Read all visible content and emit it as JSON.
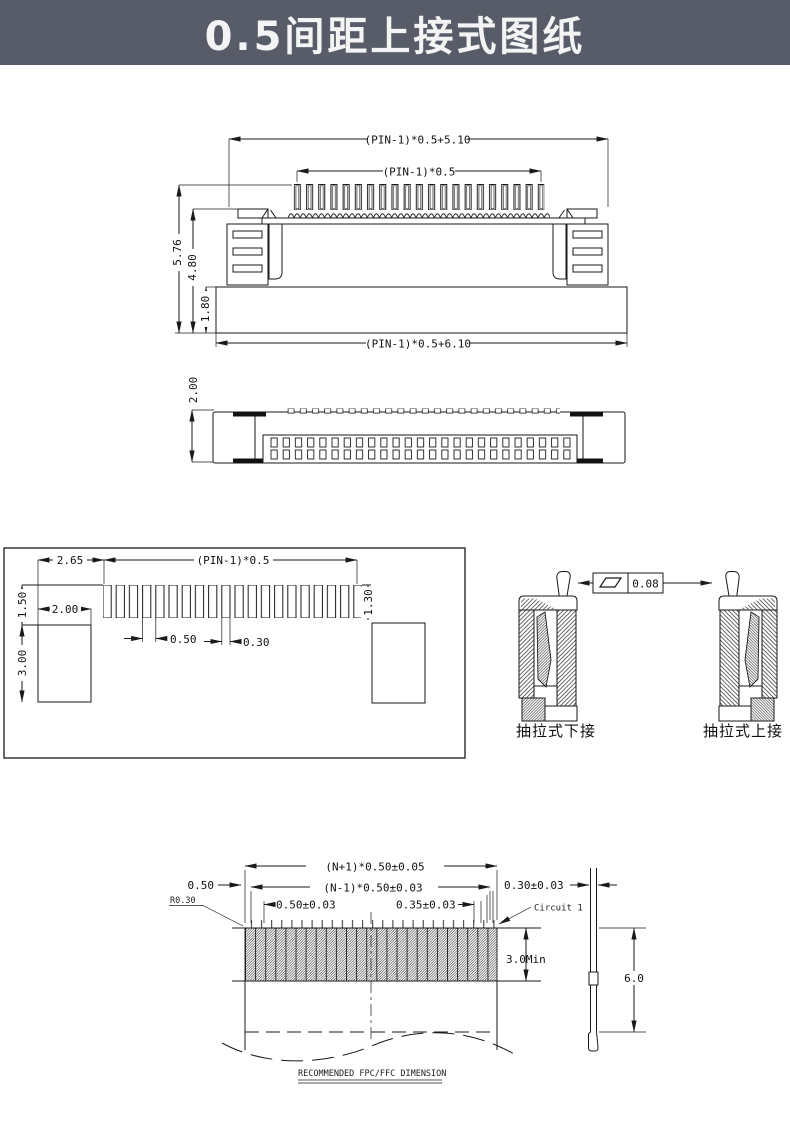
{
  "header": {
    "title": "0.5间距上接式图纸",
    "bg_color": "#575c68",
    "text_color": "#f4f4f4"
  },
  "front_view": {
    "dim_top_width": "(PIN-1)*0.5+5.10",
    "dim_pin_span": "(PIN-1)*0.5",
    "dim_height_total": "5.76",
    "dim_height_upper": "4.80",
    "dim_height_base": "1.80",
    "dim_bottom_width": "(PIN-1)*0.5+6.10"
  },
  "top_view": {
    "dim_thickness": "2.00"
  },
  "land_pattern": {
    "dim_offset": "2.65",
    "dim_span": "(PIN-1)*0.5",
    "dim_pad_len_left": "1.50",
    "dim_anchor_width": "2.00",
    "dim_anchor_height": "3.00",
    "dim_pad_len_right": "1.30",
    "dim_pitch": "0.50",
    "dim_pad_width": "0.30"
  },
  "sections": {
    "flatness_value": "0.08",
    "label_lower": "抽拉式下接",
    "label_upper": "抽拉式上接"
  },
  "fpc": {
    "dim_overall_width": "(N+1)*0.50±0.05",
    "dim_conductor_span": "(N-1)*0.50±0.03",
    "dim_edge_margin": "0.50",
    "corner_radius": "R0.30",
    "dim_pitch": "0.50±0.03",
    "dim_conductor_width": "0.35±0.03",
    "dim_thickness": "0.30±0.03",
    "circuit_label": "Circuit 1",
    "dim_contact_min": "3.0Min",
    "dim_overall_length": "6.0",
    "note": "RECOMMENDED FPC/FFC DIMENSION"
  }
}
